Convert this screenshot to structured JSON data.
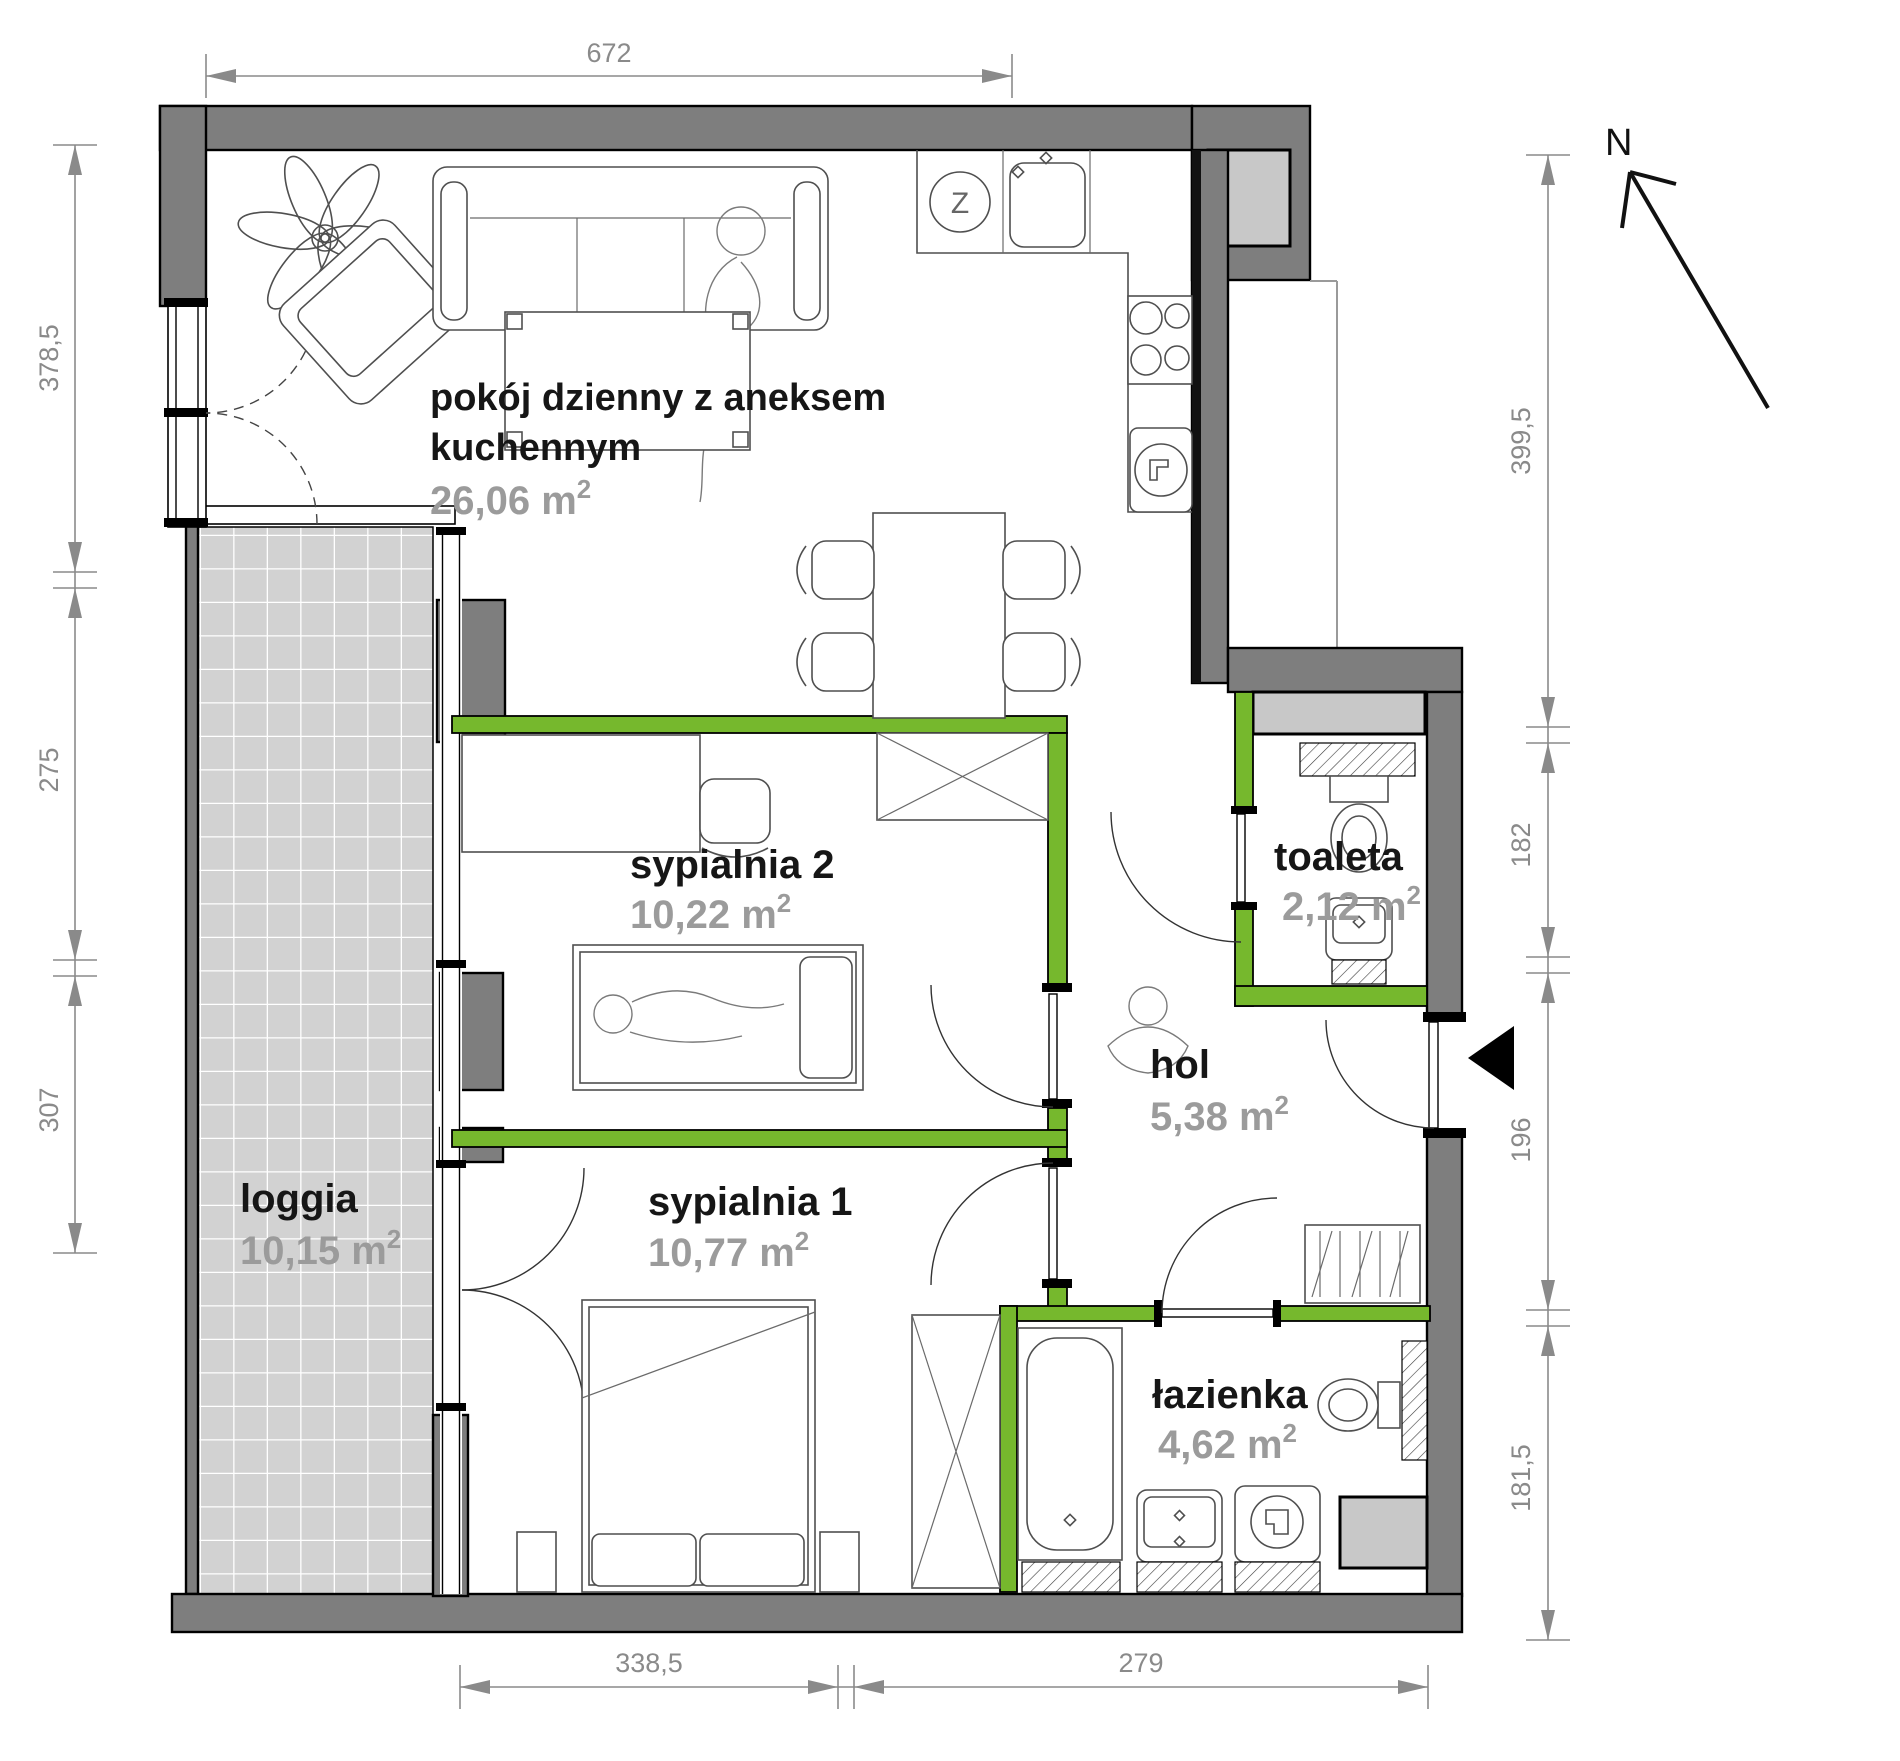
{
  "rooms": [
    {
      "name": "pokój dzienny z aneksem",
      "name_line2": "kuchennym",
      "area": "26,06 m",
      "sup": "2"
    },
    {
      "name": "sypialnia 2",
      "area": "10,22 m",
      "sup": "2"
    },
    {
      "name": "sypialnia 1",
      "area": "10,77 m",
      "sup": "2"
    },
    {
      "name": "loggia",
      "area": "10,15 m",
      "sup": "2"
    },
    {
      "name": "toaleta",
      "area": "2,12 m",
      "sup": "2"
    },
    {
      "name": "hol",
      "area": "5,38 m",
      "sup": "2"
    },
    {
      "name": "łazienka",
      "area": "4,62 m",
      "sup": "2"
    }
  ],
  "dimensions_cm": {
    "top": [
      "672"
    ],
    "left": [
      "378,5",
      "275",
      "307"
    ],
    "right": [
      "399,5",
      "182",
      "196",
      "181,5"
    ],
    "bottom": [
      "338,5",
      "279"
    ]
  },
  "compass": {
    "north_label": "N"
  },
  "appliances": {
    "dishwasher_label": "Z"
  },
  "colors": {
    "partition_green": "#76b82d",
    "exterior_wall_gray": "#7e7e7e",
    "shaft_gray": "#c8c8c8",
    "loggia_tile_gray": "#d2d2d2",
    "dimension_gray": "#8a8a8a",
    "room_label_black": "#161616",
    "area_label_gray": "#9b9b9b",
    "background": "#ffffff"
  }
}
